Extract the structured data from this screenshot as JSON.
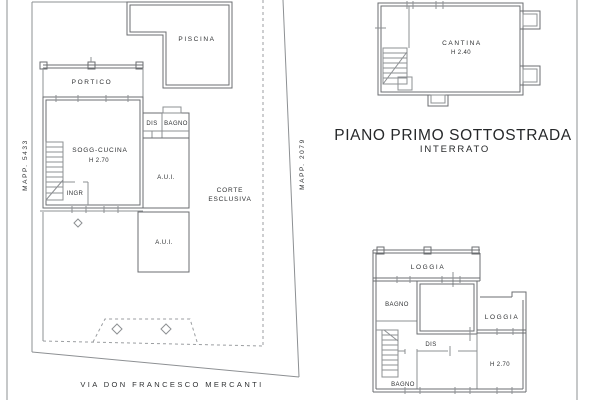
{
  "colors": {
    "background": "#ffffff",
    "line": "#8d9093",
    "wall": "#6b6e71",
    "dashed": "#9b9ea1",
    "text": "#2f3133"
  },
  "site_plan": {
    "mapp_left": "MAPP. 5433",
    "mapp_right": "MAPP. 2079",
    "street": "VIA DON FRANCESCO MERCANTI",
    "rooms": {
      "piscina": "PISCINA",
      "portico": "PORTICO",
      "dis": "DIS",
      "bagno": "BAGNO",
      "soggiorno": "SOGG-CUCINA",
      "soggiorno_height": "H 2.70",
      "ingresso": "INGR",
      "aui_upper": "A.U.I.",
      "aui_lower": "A.U.I.",
      "corte_line1": "CORTE",
      "corte_line2": "ESCLUSIVA"
    }
  },
  "basement_plan": {
    "title": "PIANO PRIMO SOTTOSTRADA",
    "subtitle": "INTERRATO",
    "rooms": {
      "cantina": "CANTINA",
      "cantina_height": "H 2.40"
    }
  },
  "first_floor_plan": {
    "rooms": {
      "loggia_top": "LOGGIA",
      "bagno_top": "BAGNO",
      "loggia_right": "LOGGIA",
      "dis": "DIS",
      "room_height": "H 2.70",
      "bagno_bottom": "BAGNO"
    }
  }
}
